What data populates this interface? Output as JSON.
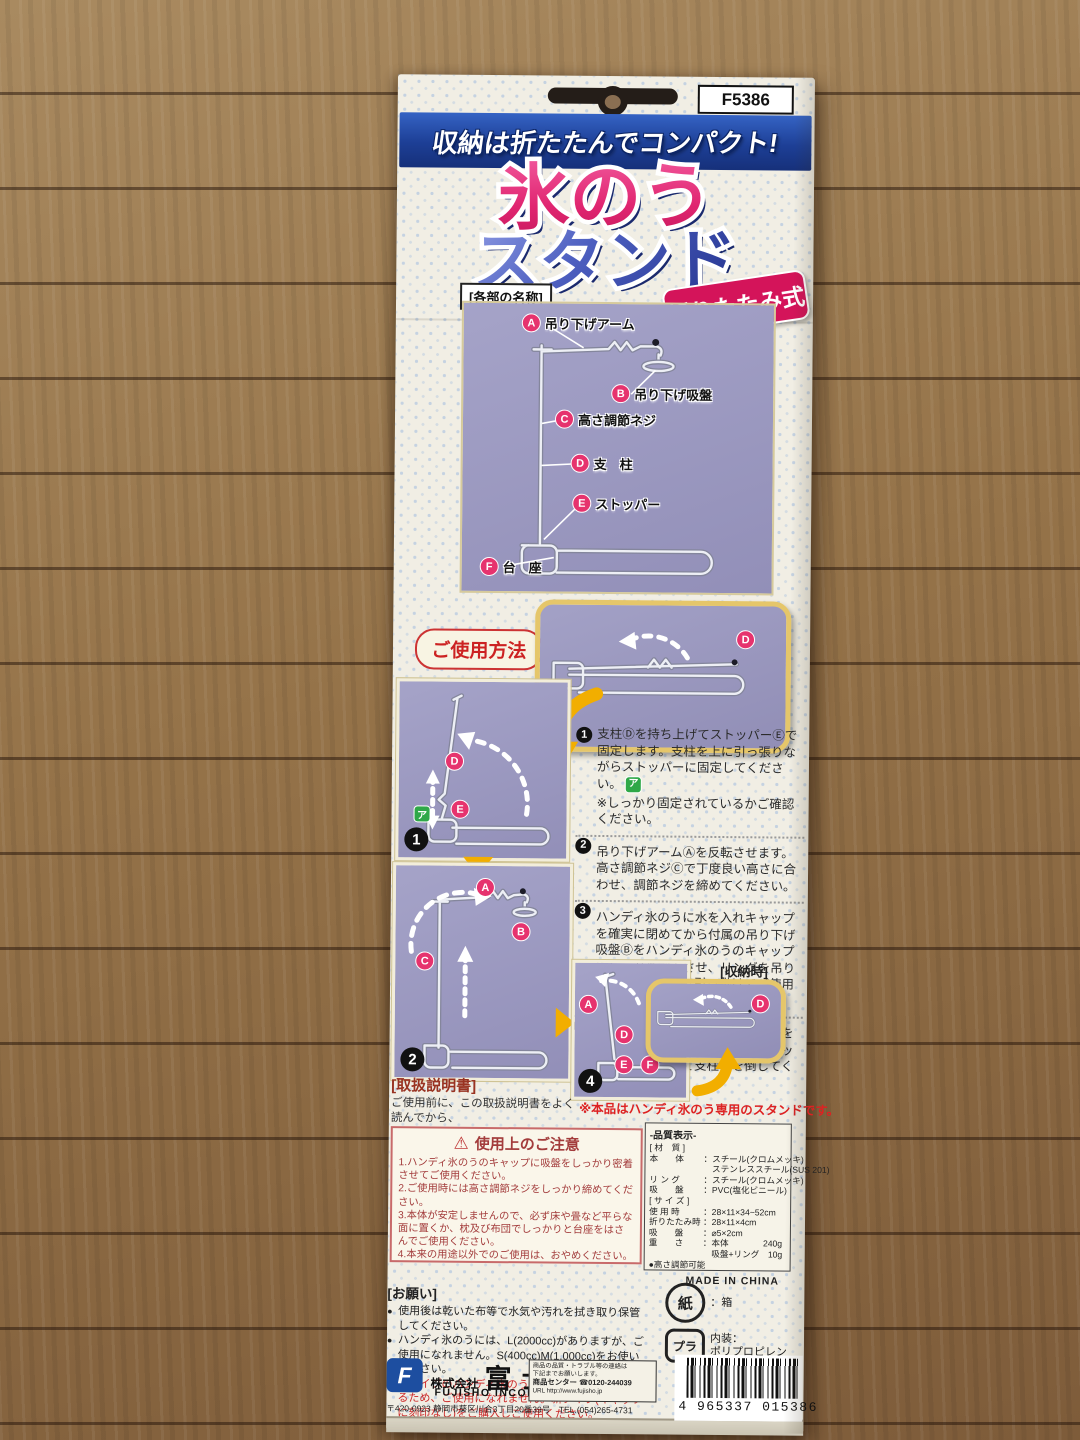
{
  "product_code": "F5386",
  "header": {
    "banner": "収納は折たたんでコンパクト!",
    "title_line1": "氷のう",
    "title_line2": "スタンド",
    "fold_badge": "折りたたみ式"
  },
  "parts_section": {
    "heading": "[各部の名称]",
    "parts": [
      {
        "letter": "A",
        "name": "吊り下げアーム"
      },
      {
        "letter": "B",
        "name": "吊り下げ吸盤"
      },
      {
        "letter": "C",
        "name": "高さ調節ネジ"
      },
      {
        "letter": "D",
        "name": "支　柱"
      },
      {
        "letter": "E",
        "name": "ストッパー"
      },
      {
        "letter": "F",
        "name": "台　座"
      }
    ]
  },
  "usage": {
    "heading": "ご使用方法",
    "steps": [
      {
        "num": "1",
        "text": "支柱Ⓓを持ち上げてストッパーⒺで固定します。支柱を上に引っ張りながらストッパーに固定してください。",
        "marker": "ア",
        "note": "※しっかり固定されているかご確認ください。"
      },
      {
        "num": "2",
        "text": "吊り下げアームⒶを反転させます。高さ調節ネジⒸで丁度良い高さに合わせ、調節ネジを締めてください。",
        "marker": "",
        "note": ""
      },
      {
        "num": "3",
        "text": "ハンディ氷のうに水を入れキャップを確実に閉めてから付属の吊り下げ吸盤Ⓑをハンディ氷のうのキャップにしっかり密着させ、リングを吊り下げアーム先端に引っ掛けてご使用ください。(表面の写真参照)",
        "marker": "",
        "note": ""
      },
      {
        "num": "4",
        "text": "収納する時は、吊り下げアームⒶを元の方向に戻して、台座ⒻのストッパーⒺを解除して支柱Ⓓを倒してください。",
        "marker": "",
        "note": ""
      }
    ],
    "badges": {
      "s1": "1",
      "s2": "2",
      "s4": "4"
    },
    "marker_a": "ア",
    "stored_label": "[収納時]",
    "exclusive_note": "※本品はハンディ氷のう専用のスタンドです。"
  },
  "manual": {
    "heading": "[取扱説明書]",
    "text": "ご使用前に、この取扱説明書をよく読んでから、\n正しくご使用ください。"
  },
  "caution": {
    "heading": "使用上のご注意",
    "items": [
      "1.ハンディ氷のうのキャップに吸盤をしっかり密着させてご使用ください。",
      "2.ご使用時には高さ調節ネジをしっかり締めてください。",
      "3.本体が安定しませんので、必ず床や畳など平らな面に置くか、枕及び布団でしっかりと台座をはさんでご使用ください。",
      "4.本来の用途以外でのご使用は、おやめください。"
    ]
  },
  "quality": {
    "title": "-品質表示-",
    "rows": [
      {
        "k": "[ 材　質 ]",
        "v": ""
      },
      {
        "k": "本　　体",
        "v": "：スチール(クロムメッキ)"
      },
      {
        "k": "",
        "v": "　ステンレススチール(SUS 201)"
      },
      {
        "k": "リ ン グ",
        "v": "：スチール(クロムメッキ)"
      },
      {
        "k": "吸　　盤",
        "v": "：PVC(塩化ビニール)"
      },
      {
        "k": "[ サ イ ズ ]",
        "v": ""
      },
      {
        "k": "使 用 時",
        "v": "：28×11×34~52cm"
      },
      {
        "k": "折りたたみ時",
        "v": "：28×11×4cm"
      },
      {
        "k": "吸　　盤",
        "v": "：⌀5×2cm"
      },
      {
        "k": "重　　さ",
        "v": "：本体　　　　240g"
      },
      {
        "k": "",
        "v": "　吸盤+リング　10g"
      },
      {
        "k": "●高さ調節可能",
        "v": ""
      }
    ],
    "made_in": "MADE IN CHINA"
  },
  "request": {
    "heading": "[お願い]",
    "items": [
      "使用後は乾いた布等で水気や汚れを拭き取り保管してください。",
      "ハンディ氷のうには、L(2000cc)がありますが、ご使用になれません。S(400cc)M(1,000cc)をお使いください。",
      "旧タイプのハンディ氷のうはキャップに刻印があるため、ご使用になれません。新タイプ(キャップに刻印なし)をご購入しご使用ください。"
    ]
  },
  "recycle": {
    "paper_mark": "紙",
    "paper_label": "：箱",
    "plastic_mark": "プラ",
    "plastic_label": "内装：\nポリプロピレン"
  },
  "footer": {
    "logo_letter": "F",
    "company_prefix": "株式会社",
    "company": "富士商",
    "company_en": "FUJISHO INCORPORATION",
    "address": "〒420-0923 静岡市葵区川合3丁目20番39号　TEL.(054)265-4731",
    "contact_line1": "商品の品質・トラブル等の連絡は",
    "contact_line2": "下記までお願いします。",
    "contact_line3": "商品センター ☎0120-244039",
    "contact_line4": "URL http://www.fujisho.jp",
    "barcode_digits": "4 965337 015386"
  },
  "colors": {
    "title_pink": "#e02570",
    "title_blue": "#24348f",
    "banner_blue": "#1d3f96",
    "badge_pink": "#d4145a",
    "panel_purple": "#9e9cc2",
    "caution_red": "#a33c3c",
    "arrow_yellow": "#f2ae00"
  }
}
